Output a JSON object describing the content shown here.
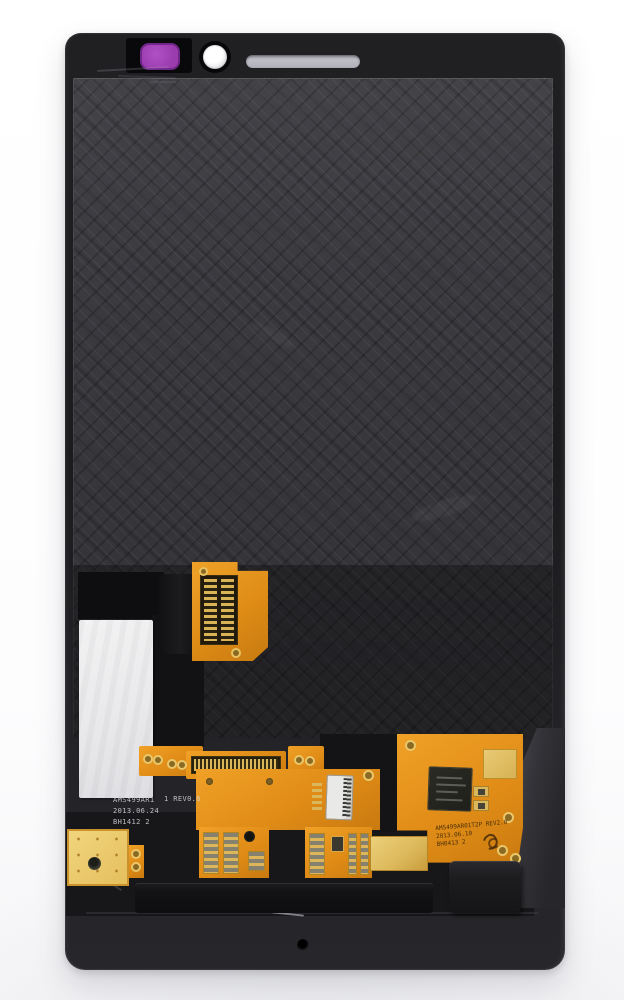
{
  "image": {
    "type": "product-photo",
    "subject": "smartphone LCD display and touch digitizer assembly, back side, on white background"
  },
  "colors": {
    "background": "#ffffff",
    "frame_black": "#1c1c1f",
    "panel_gray": "#3a3a3f",
    "flex_orange": "#e08c17",
    "gold_pad": "#d9b75a",
    "gold_plate": "#ecca6d",
    "label_white": "#ebebec",
    "sticker_purple": "#a344b8",
    "earpiece_gray": "#b6b6bf",
    "camera_white": "#f2f2f4"
  },
  "markings": {
    "panel_print": {
      "line1": "AMS499AR1",
      "line2": "2013.06.24",
      "line3": "BH1412 2"
    },
    "panel_rev": "1 REV0.6",
    "flex_print": {
      "line1": "AMS499AR01T2P REV2.0",
      "line2": "2013.06.10",
      "line3": "BH0413 2"
    }
  },
  "part_names": {
    "sticker": "proximity-sensor-sticker",
    "camera": "front-camera-opening",
    "earpiece": "earpiece-slot",
    "label": "blank-white-label",
    "small_flex": "lcd-flex-connector",
    "main_flex": "digitizer-main-flex-board",
    "ic": "touch-driver-ic",
    "connector": "black-board-connector",
    "hole": "microphone-hole"
  }
}
